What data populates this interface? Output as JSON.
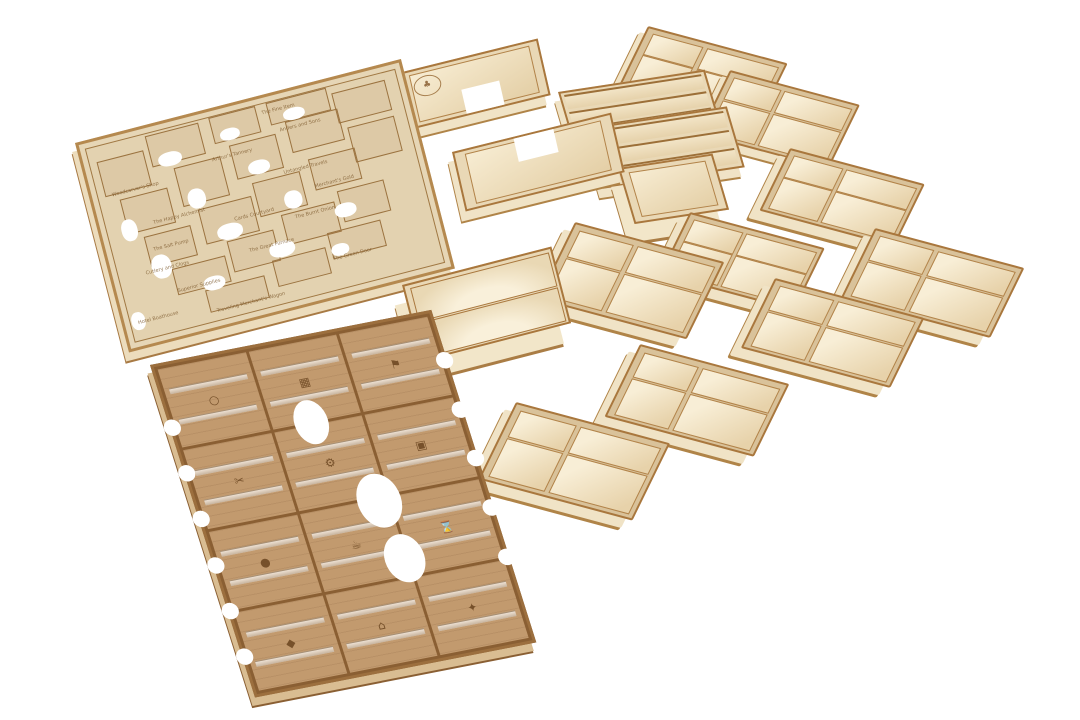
{
  "scene": {
    "subject": "Laser-cut plywood board game organizer insert set on a white background",
    "background_color": "#ffffff",
    "piece_count": 17
  },
  "colors": {
    "background": "#ffffff",
    "wood_face": "#e6d6b6",
    "wood_light": "#f6ecd4",
    "wood_edge_burn": "#a9773d",
    "burn_line_dark": "#8a5f33",
    "dark_board": "#c29a6e",
    "engraving": "#7d5a2e",
    "acrylic_divider": "#e8ecee"
  },
  "location_board": {
    "name": "engraved location board",
    "labels": [
      {
        "text": "The Fine Item"
      },
      {
        "text": "Anders and Sons"
      },
      {
        "text": "Arthur's Tannery"
      },
      {
        "text": "Woodcarver's Shop"
      },
      {
        "text": "Untangled Travels"
      },
      {
        "text": "Merchant's Gold"
      },
      {
        "text": "The Happy Alchemist"
      },
      {
        "text": "Cards Courtyard"
      },
      {
        "text": "The Burnt Onion"
      },
      {
        "text": "The Salt Pump"
      },
      {
        "text": "Cutlery and Clogs"
      },
      {
        "text": "The Great Furnace"
      },
      {
        "text": "Superior Supplies"
      },
      {
        "text": "Hotel Boathouse"
      },
      {
        "text": "The Green Door"
      },
      {
        "text": "Traveling Merchant's Wagon"
      }
    ]
  },
  "card_rack_board": {
    "name": "card rack board with acrylic dividers",
    "icons": [
      {
        "name": "ring-icon",
        "glyph": "○"
      },
      {
        "name": "abacus-icon",
        "glyph": "▦"
      },
      {
        "name": "banner-icon",
        "glyph": "⚑"
      },
      {
        "name": "shears-icon",
        "glyph": "✂"
      },
      {
        "name": "gear-icon",
        "glyph": "⚙"
      },
      {
        "name": "frame-icon",
        "glyph": "▣"
      },
      {
        "name": "hourglass-icon",
        "glyph": "⌛"
      },
      {
        "name": "mug-icon",
        "glyph": "☕"
      },
      {
        "name": "gem-icon",
        "glyph": "◆"
      },
      {
        "name": "pouch-icon",
        "glyph": "●"
      },
      {
        "name": "house-icon",
        "glyph": "⌂"
      },
      {
        "name": "compass-icon",
        "glyph": "✦"
      }
    ]
  },
  "logo_tray": {
    "name": "L-shaped tray with engraved oval emblem",
    "logo_glyph": "♣"
  },
  "l_tray": {
    "name": "L-shaped open tray"
  },
  "tiered_tray": {
    "name": "tiered card tray",
    "count": 2
  },
  "deep_box": {
    "name": "deep open token box"
  },
  "dual_card_box": {
    "name": "two-well card box"
  },
  "quad_tray": {
    "name": "four-compartment tray",
    "count": 9
  }
}
